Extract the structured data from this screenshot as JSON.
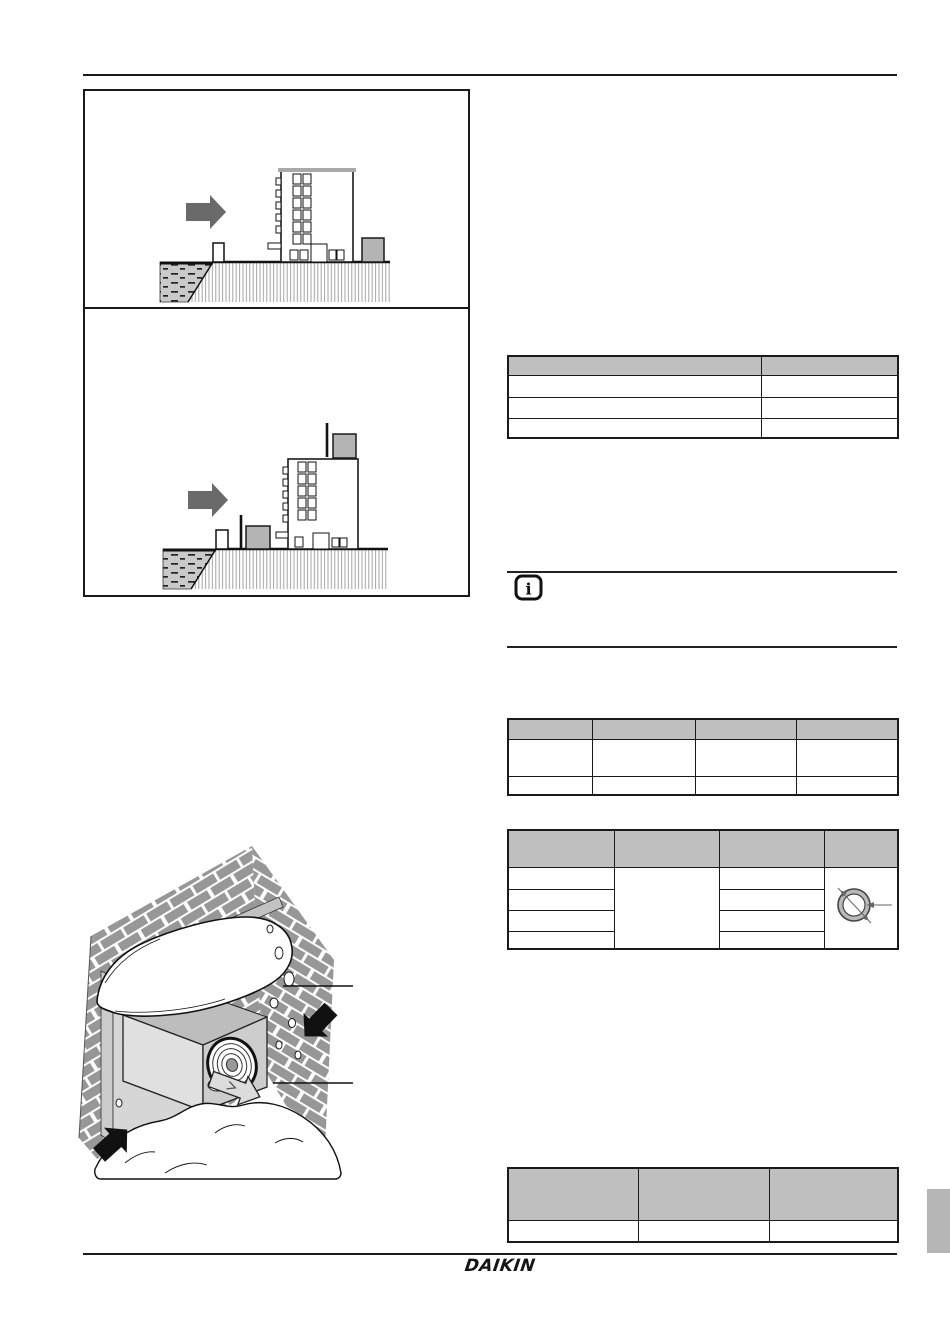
{
  "page": {
    "width": 950,
    "height": 1343,
    "background": "#ffffff"
  },
  "footer": {
    "logo_text": "DAIKIN"
  },
  "colors": {
    "line": "#1a1a1a",
    "table_header_bg": "#bfbfbf",
    "wind_arrow_gray": "#6a6a6a",
    "unit_gray": "#b4b4b4",
    "brick_gray": "#979797",
    "sea_gray": "#c9c9c9",
    "side_tab_gray": "#b5b5b5"
  },
  "figures": {
    "figure1": {
      "description_icon": "sea-wind-building-diagram-1"
    },
    "figure2": {
      "description_icon": "sea-wind-building-diagram-2"
    },
    "figure3": {
      "description_icon": "snow-covered-wall-mounted-unit-diagram"
    }
  },
  "note": {
    "icon": "info"
  },
  "tables": {
    "table1": {
      "header": [
        "",
        ""
      ],
      "rows": [
        [
          "",
          ""
        ],
        [
          "",
          ""
        ],
        [
          "",
          ""
        ]
      ]
    },
    "table2": {
      "header": [
        "",
        "",
        "",
        ""
      ],
      "rows": [
        [
          "",
          "",
          "",
          ""
        ],
        [
          "",
          "",
          "",
          ""
        ]
      ]
    },
    "table3": {
      "header": [
        "",
        "",
        "",
        ""
      ],
      "column1_rows": [
        "",
        "",
        "",
        ""
      ],
      "column2_merged": "",
      "column3_rows": [
        "",
        "",
        "",
        ""
      ],
      "column4_merged_icon": "pipe-cross-section"
    },
    "table4": {
      "header": [
        "",
        "",
        ""
      ],
      "rows": [
        [
          "",
          "",
          ""
        ]
      ]
    }
  }
}
